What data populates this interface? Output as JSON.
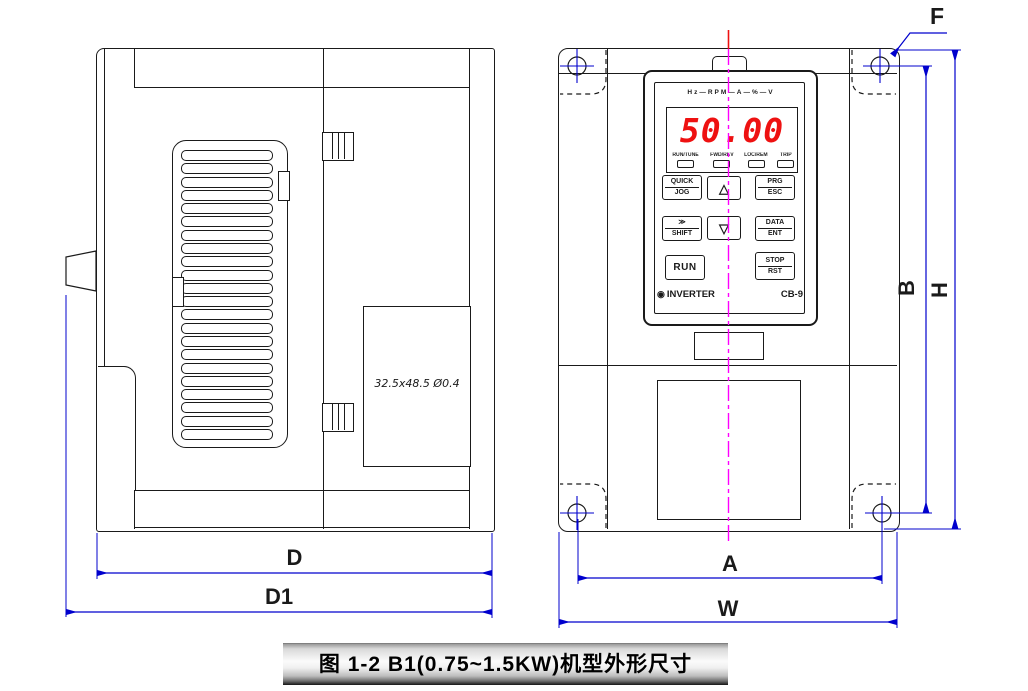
{
  "figure": {
    "caption": "图 1-2 B1(0.75~1.5KW)机型外形尺寸"
  },
  "side_view": {
    "label_plate": "32.5x48.5 Ø0.4",
    "dim_depth": "D",
    "dim_total_depth": "D1"
  },
  "front_view": {
    "dim_hole_span_width": "A",
    "dim_width": "W",
    "dim_hole_span_height": "B",
    "dim_height": "H",
    "dim_mount_hole": "F",
    "keypad": {
      "unit_indicator_row": "Hz—RPM—A—%—V",
      "display_value": "50.00",
      "status_leds": [
        "RUN/TUNE",
        "FWD/REV",
        "LOC/REM",
        "TRIP"
      ],
      "buttons": {
        "quick": "QUICK",
        "jog": "JOG",
        "up": "△",
        "prg": "PRG",
        "esc": "ESC",
        "shift_glyph": "≫",
        "shift": "SHIFT",
        "down": "▽",
        "data": "DATA",
        "ent": "ENT",
        "run": "RUN",
        "stop": "STOP",
        "rst": "RST"
      },
      "brand_logo_glyph": "◉",
      "brand": "INVERTER",
      "model": "CB-9"
    }
  },
  "colors": {
    "drawing_line": "#1a1a1a",
    "dimension_line": "#0000cd",
    "centerline": "#ff00ff",
    "display_digits": "#ee1111"
  }
}
